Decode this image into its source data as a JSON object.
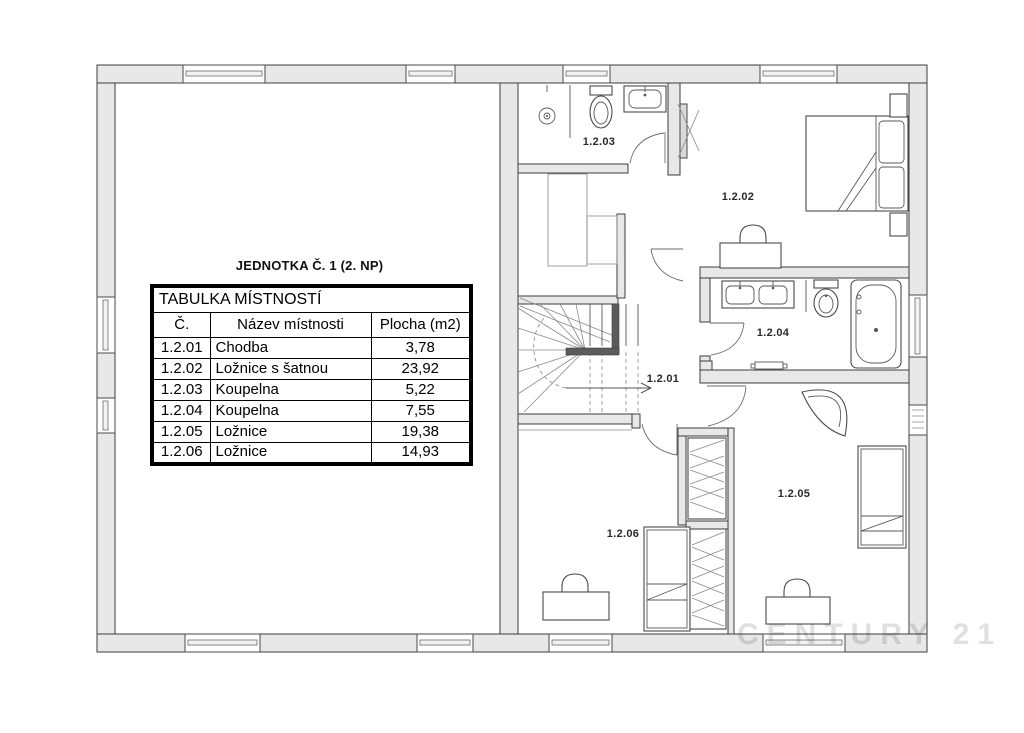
{
  "title": "JEDNOTKA Č. 1 (2. NP)",
  "watermark": "CENTURY 21",
  "table": {
    "header": "TABULKA MÍSTNOSTÍ",
    "columns": [
      "Č.",
      "Název místnosti",
      "Plocha (m2)"
    ],
    "rows": [
      {
        "num": "1.2.01",
        "name": "Chodba",
        "area": "3,78"
      },
      {
        "num": "1.2.02",
        "name": "Ložnice s šatnou",
        "area": "23,92"
      },
      {
        "num": "1.2.03",
        "name": "Koupelna",
        "area": "5,22"
      },
      {
        "num": "1.2.04",
        "name": "Koupelna",
        "area": "7,55"
      },
      {
        "num": "1.2.05",
        "name": "Ložnice",
        "area": "19,38"
      },
      {
        "num": "1.2.06",
        "name": "Ložnice",
        "area": "14,93"
      }
    ]
  },
  "plan": {
    "labels": [
      {
        "id": "1.2.03"
      },
      {
        "id": "1.2.02"
      },
      {
        "id": "1.2.04"
      },
      {
        "id": "1.2.01"
      },
      {
        "id": "1.2.05"
      },
      {
        "id": "1.2.06"
      }
    ]
  },
  "colors": {
    "wall_fill": "#e8e8e8",
    "line": "#3c3c3c",
    "table_border": "#000000",
    "watermark_gray": "#e0e0e0"
  }
}
